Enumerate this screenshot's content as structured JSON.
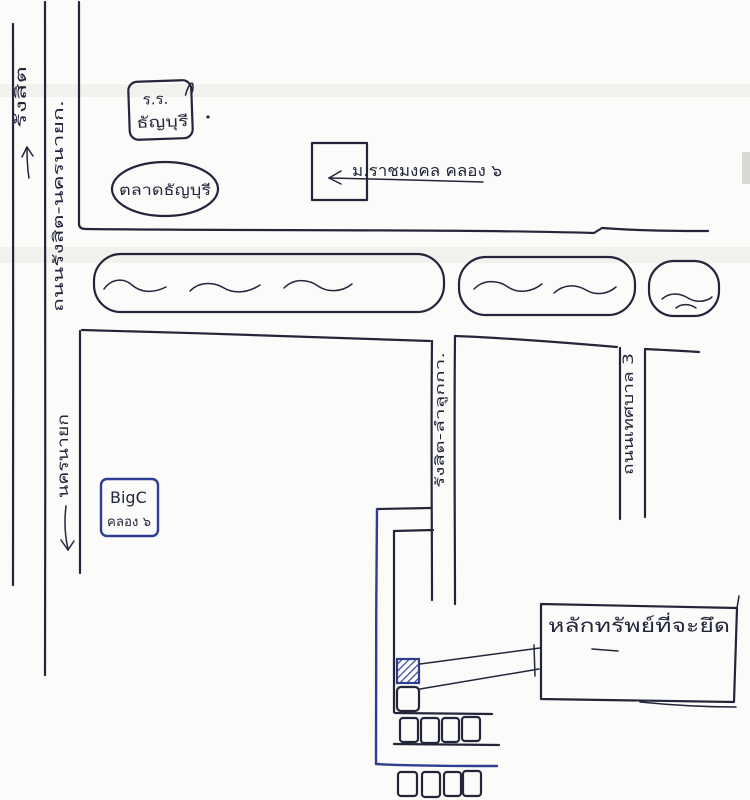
{
  "map": {
    "labels": {
      "direction_top": "รังสิต",
      "main_road": "ถนนรังสิต-นครนายก.",
      "direction_bottom": "นครนายก",
      "school_line1": "ร.ร.",
      "school_line2": "ธัญบุรี",
      "market": "ตลาดธัญบุรี",
      "university": "ม.ราชมงคล คลอง ๖",
      "bigc_line1": "BigC",
      "bigc_line2": "คลอง ๖",
      "side_road": "รังสิต-ลำลูกกา.",
      "thetsaban_road": "ถนนเทศบาล 3",
      "property": "หลักทรัพย์ที่จะยึด"
    },
    "colors": {
      "ink": "#23263b",
      "blue_ink": "#2f3e92",
      "paper": "#fbfbf9",
      "scan_band": "#e9e9e5"
    }
  }
}
